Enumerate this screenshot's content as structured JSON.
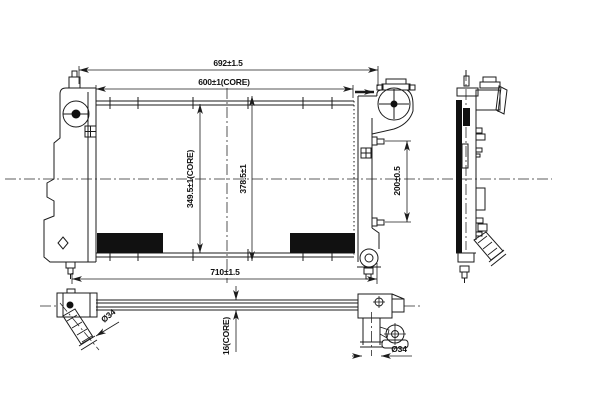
{
  "drawing": {
    "subject": "Radiator engineering drawing with front, bottom and side views",
    "background_color": "#ffffff",
    "line_color": "#1b1b1b",
    "labels": {
      "overall_width": "692±1.5",
      "core_width": "600±1(CORE)",
      "core_height": "349.5±1(CORE)",
      "overall_height": "378.5±1",
      "mounting_pin_spacing": "200±0.5",
      "overall_length": "710±1.5",
      "inlet_pipe_diameter": "Ø34",
      "core_thickness": "16(CORE)",
      "outlet_pipe_diameter": "Ø34"
    }
  }
}
